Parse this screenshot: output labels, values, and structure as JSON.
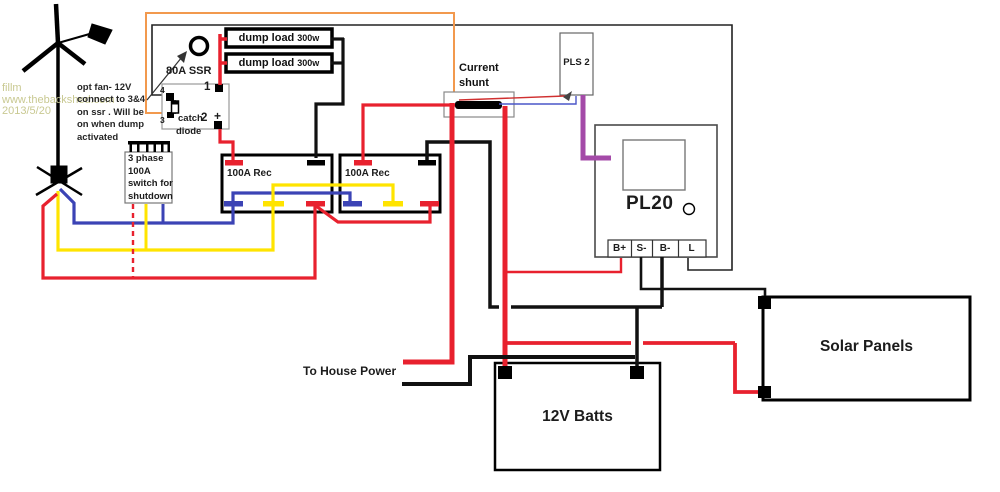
{
  "watermark": {
    "lines": [
      "fillm",
      "www.thebackshed.com",
      "2013/5/20"
    ],
    "color": "#c9c992"
  },
  "note": {
    "lines": [
      "opt fan- 12V",
      "connect to 3&4",
      "on ssr . Will be",
      "on when dump",
      "activated"
    ]
  },
  "ssr": {
    "title": "80A SSR",
    "t1": "1",
    "t2": "2",
    "t2_plus": "+",
    "t3": "3",
    "t4": "4",
    "diode_lines": [
      "catch",
      "diode"
    ]
  },
  "dump_loads": {
    "label": "dump load",
    "power": "300w"
  },
  "shutdown_switch": {
    "lines": [
      "3 phase",
      "100A",
      "switch for",
      "shutdown"
    ]
  },
  "rectifiers": {
    "label": "100A Rec"
  },
  "shunt": {
    "lines": [
      "Current",
      "shunt"
    ]
  },
  "pls2": {
    "label": "PLS 2"
  },
  "pl20": {
    "label": "PL20",
    "terminals": [
      "B+",
      "S-",
      "B-",
      "L"
    ]
  },
  "battery": {
    "label": "12V Batts"
  },
  "solar": {
    "label": "Solar Panels"
  },
  "house": {
    "label": "To House Power"
  },
  "colors": {
    "wire_red": "#e8212e",
    "wire_black": "#111111",
    "wire_blue": "#3b43b5",
    "wire_yellow": "#ffe400",
    "wire_purple": "#a44aa8",
    "wire_orange": "#f2994e",
    "watermark": "#c9c992"
  }
}
